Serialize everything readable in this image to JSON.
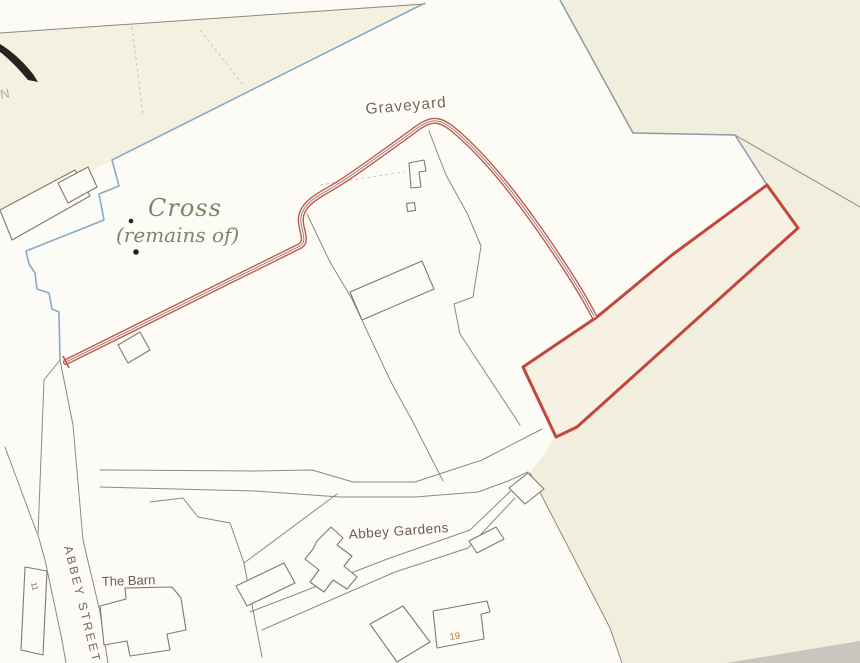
{
  "map": {
    "labels": {
      "graveyard": "Graveyard",
      "cross_line1": "Cross",
      "cross_line2": "(remains of)",
      "abbey_gardens": "Abbey Gardens",
      "the_barn": "The Barn",
      "abbey_street": "ABBEY STREET",
      "house_19": "19",
      "house_11": "11",
      "north_mark": "N"
    },
    "colors": {
      "paper_white": "#fcfbf5",
      "paper_cream": "#f2eedd",
      "strip_fill": "#f6f1e2",
      "boundary_red": "#c2453e",
      "path_red": "#c65550",
      "boundary_blue": "#7fa5c5",
      "boundary_bluegray": "#8b9aa6",
      "line_gray": "#8d8a7e",
      "building_gray": "#7e7a6e",
      "label_brown": "#6f5a52",
      "label_graybrown": "#746a5c",
      "label_olive": "#83826a",
      "label_orange": "#bc7b41",
      "ink_black": "#262420",
      "scan_band_gray": "#c9c6c0"
    }
  }
}
